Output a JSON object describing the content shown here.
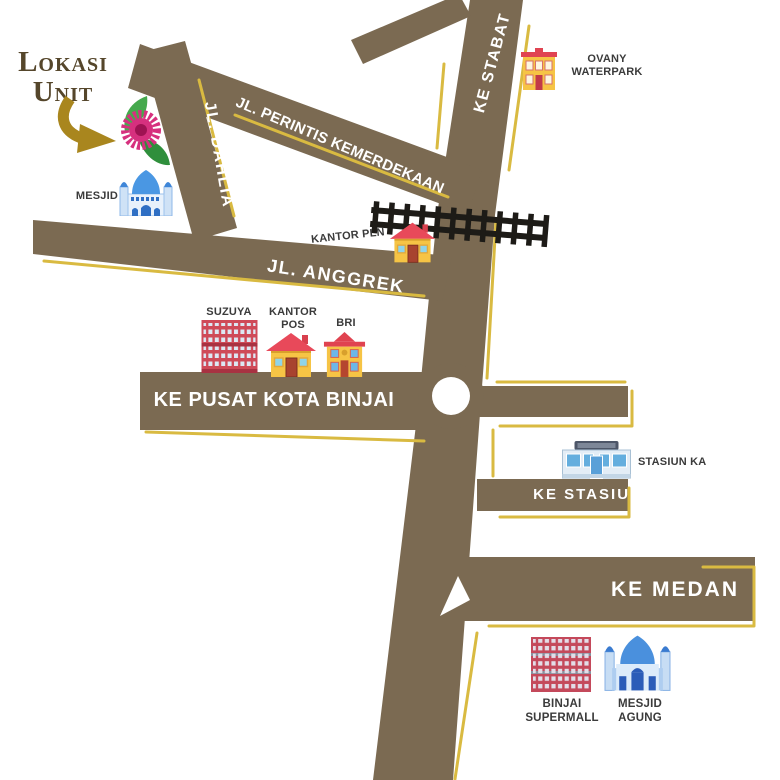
{
  "map": {
    "legend_title_line1": "Lokasi",
    "legend_title_line2": "Unit"
  },
  "roads": {
    "ke_stabat": "KE STABAT",
    "jl_perintis_kemerdekaan": "JL. PERINTIS KEMERDEKAAN",
    "jl_dahlia": "JL. DAHLIA",
    "jl_anggrek": "JL. ANGGREK",
    "ke_pusat_kota_binjai": "KE PUSAT KOTA BINJAI",
    "ke_stasiun": "KE STASIUN",
    "ke_medan": "KE MEDAN"
  },
  "landmarks": {
    "mesjid": {
      "label": "MESJID",
      "icon": "mosque-icon"
    },
    "ovany_waterpark": {
      "line1": "OVANY",
      "line2": "WATERPARK",
      "icon": "building-icon"
    },
    "kantor_pln": {
      "label": "KANTOR PLN",
      "icon": "house-icon"
    },
    "suzuya": {
      "label": "SUZUYA",
      "icon": "mall-icon"
    },
    "kantor_pos": {
      "line1": "KANTOR",
      "line2": "POS",
      "icon": "house-icon"
    },
    "bri": {
      "label": "BRI",
      "icon": "bank-icon"
    },
    "stasiun_ka": {
      "label": "STASIUN KA",
      "icon": "station-icon"
    },
    "binjai_supermall": {
      "line1": "BINJAI",
      "line2": "SUPERMALL",
      "icon": "mall-icon"
    },
    "mesjid_agung": {
      "line1": "MESJID",
      "line2": "AGUNG",
      "icon": "mosque-icon"
    }
  },
  "colors": {
    "road": "#7b6a52",
    "outline_yellow": "#d9ba41",
    "title_text": "#55462b",
    "road_text": "#ffffff",
    "label_text": "#3b3b3b",
    "arrow_gold": "#a9861e",
    "flower_pink": "#d6307e",
    "railroad_black": "#1d1b17"
  }
}
